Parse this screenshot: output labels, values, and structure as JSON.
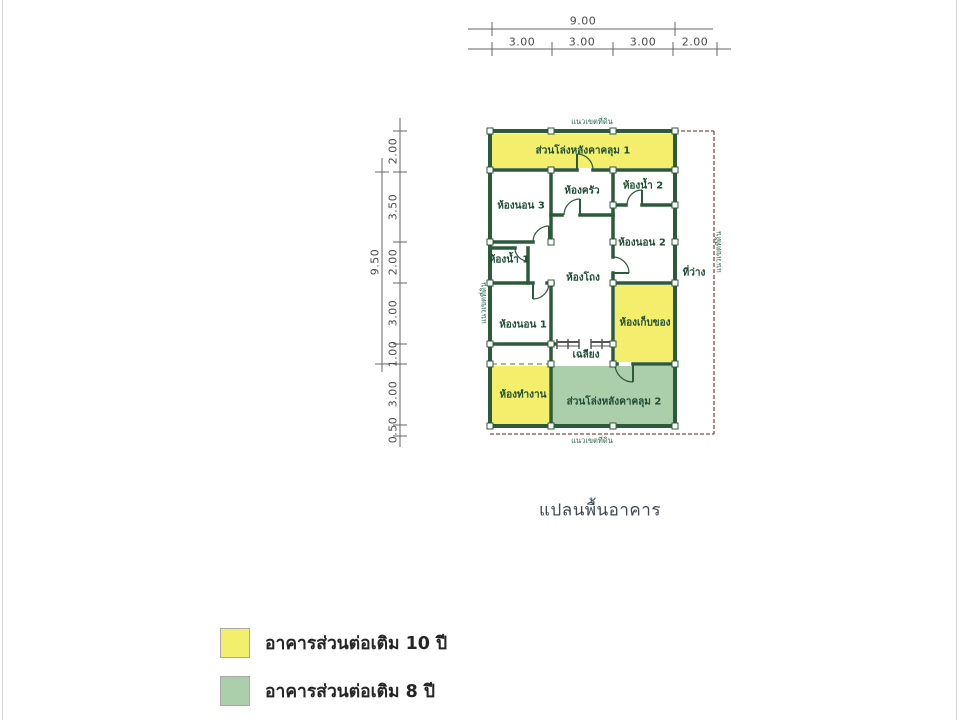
{
  "title": "แปลนพื้นอาคาร",
  "boundary": {
    "label": "แนวเขตที่ดิน"
  },
  "dimensions": {
    "top": {
      "total": "9.00",
      "segments": [
        "3.00",
        "3.00",
        "3.00",
        "2.00"
      ]
    },
    "left": {
      "total": "9.50",
      "segments": [
        "2.00",
        "3.50",
        "2.00",
        "3.00",
        "1.00",
        "3.00",
        "0.50"
      ]
    }
  },
  "rooms": [
    {
      "label": "ส่วนโล่งหลังคาคลุม 1"
    },
    {
      "label": "ห้องนอน 3"
    },
    {
      "label": "ห้องครัว"
    },
    {
      "label": "ห้องน้ำ 2"
    },
    {
      "label": "ห้องนอน 2"
    },
    {
      "label": "ห้องน้ำ 1"
    },
    {
      "label": "ห้องโถง"
    },
    {
      "label": "ที่ว่าง"
    },
    {
      "label": "ห้องนอน 1"
    },
    {
      "label": "ห้องเก็บของ"
    },
    {
      "label": "เฉลียง"
    },
    {
      "label": "ห้องทำงาน"
    },
    {
      "label": "ส่วนโล่งหลังคาคลุม 2"
    }
  ],
  "legend": {
    "items": [
      {
        "label": "อาคารส่วนต่อเติม 10 ปี",
        "color": "#f3ef6d"
      },
      {
        "label": "อาคารส่วนต่อเติม 8 ปี",
        "color": "#abceab"
      }
    ]
  },
  "colors": {
    "wall": "#2d5a3a",
    "addition_10yr_fill": "#f3ef6d",
    "addition_8yr_fill": "#abceab",
    "boundary_line": "#8b4a3c",
    "dimension_line": "#666666",
    "room_text": "#1e4d33",
    "title_text": "#3d4852",
    "legend_text": "#252525"
  }
}
